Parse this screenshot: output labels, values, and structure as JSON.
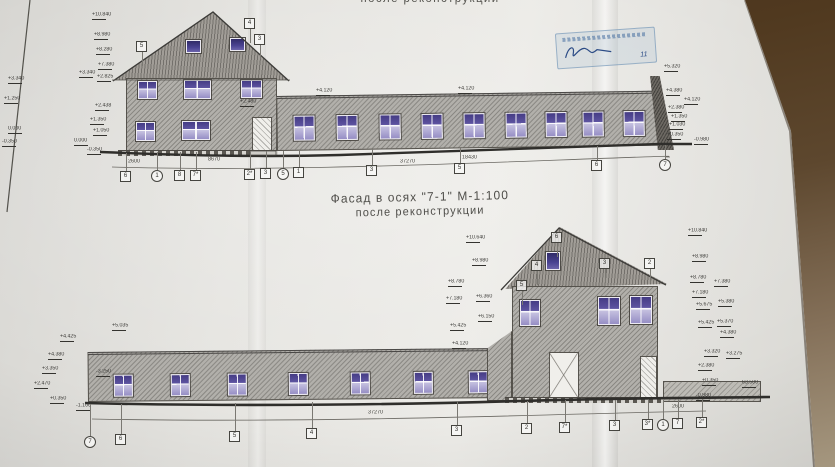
{
  "titles": {
    "top_clipped": "после реконструкции",
    "main": "Фасад в осях \"7-1\"   М-1:100",
    "sub": "после реконструкции"
  },
  "stamp": {
    "date": "11"
  },
  "top": {
    "marks": [
      {
        "v": "+10.840",
        "x": 92,
        "y": 12
      },
      {
        "v": "+8.980",
        "x": 94,
        "y": 32
      },
      {
        "v": "+8.280",
        "x": 96,
        "y": 47
      },
      {
        "v": "+7.380",
        "x": 98,
        "y": 62
      },
      {
        "v": "+2.825",
        "x": 97,
        "y": 74
      },
      {
        "v": "+3.340",
        "x": 79,
        "y": 70
      },
      {
        "v": "+2.438",
        "x": 95,
        "y": 103
      },
      {
        "v": "+1.350",
        "x": 90,
        "y": 117
      },
      {
        "v": "+1.050",
        "x": 93,
        "y": 128
      },
      {
        "v": "0.000",
        "x": 74,
        "y": 138
      },
      {
        "v": "-0.350",
        "x": 87,
        "y": 147
      },
      {
        "v": "+3.340",
        "x": 8,
        "y": 76
      },
      {
        "v": "+1.250",
        "x": 4,
        "y": 96
      },
      {
        "v": "0.000",
        "x": 8,
        "y": 126
      },
      {
        "v": "-0.350",
        "x": 2,
        "y": 139
      },
      {
        "v": "+5.320",
        "x": 664,
        "y": 64
      },
      {
        "v": "+4.380",
        "x": 666,
        "y": 88
      },
      {
        "v": "+4.120",
        "x": 684,
        "y": 97
      },
      {
        "v": "+2.380",
        "x": 668,
        "y": 105
      },
      {
        "v": "+1.350",
        "x": 671,
        "y": 114
      },
      {
        "v": "+1.030",
        "x": 669,
        "y": 122
      },
      {
        "v": "+0.350",
        "x": 667,
        "y": 132
      },
      {
        "v": "-0.980",
        "x": 694,
        "y": 137
      },
      {
        "v": "+4.120",
        "x": 316,
        "y": 88
      },
      {
        "v": "+4.120",
        "x": 458,
        "y": 86
      },
      {
        "v": "+2.480",
        "x": 240,
        "y": 99
      }
    ],
    "dims": [
      {
        "v": "2600",
        "x": 128,
        "y": 159
      },
      {
        "v": "8670",
        "x": 208,
        "y": 157
      },
      {
        "v": "37270",
        "x": 400,
        "y": 159
      },
      {
        "v": "18430",
        "x": 462,
        "y": 155
      }
    ],
    "axes": [
      {
        "l": "6",
        "t": "sq",
        "x": 126,
        "y": 177
      },
      {
        "l": "1",
        "t": "ci",
        "x": 157,
        "y": 176
      },
      {
        "l": "8",
        "t": "sq",
        "x": 180,
        "y": 176
      },
      {
        "l": "7*",
        "t": "sq",
        "x": 196,
        "y": 176
      },
      {
        "l": "2*",
        "t": "sq",
        "x": 250,
        "y": 175
      },
      {
        "l": "3",
        "t": "sq",
        "x": 266,
        "y": 174
      },
      {
        "l": "5",
        "t": "ci",
        "x": 283,
        "y": 174
      },
      {
        "l": "1",
        "t": "sq",
        "x": 299,
        "y": 173
      },
      {
        "l": "3",
        "t": "sq",
        "x": 372,
        "y": 171
      },
      {
        "l": "5",
        "t": "sq",
        "x": 460,
        "y": 169
      },
      {
        "l": "6",
        "t": "sq",
        "x": 597,
        "y": 166
      },
      {
        "l": "7",
        "t": "ci",
        "x": 665,
        "y": 165
      }
    ],
    "roof_axes": [
      {
        "l": "5",
        "x": 142,
        "y": 47
      },
      {
        "l": "4",
        "x": 250,
        "y": 24
      },
      {
        "l": "3",
        "x": 260,
        "y": 40
      }
    ]
  },
  "bottom": {
    "marks": [
      {
        "v": "+5.035",
        "x": 112,
        "y": 323
      },
      {
        "v": "+4.425",
        "x": 60,
        "y": 334
      },
      {
        "v": "+4.380",
        "x": 48,
        "y": 352
      },
      {
        "v": "+3.350",
        "x": 42,
        "y": 366
      },
      {
        "v": "-3.250",
        "x": 96,
        "y": 369
      },
      {
        "v": "+2.470",
        "x": 34,
        "y": 381
      },
      {
        "v": "+0.350",
        "x": 50,
        "y": 396
      },
      {
        "v": "-1.100",
        "x": 76,
        "y": 403
      },
      {
        "v": "+10.640",
        "x": 466,
        "y": 235
      },
      {
        "v": "+8.980",
        "x": 472,
        "y": 258
      },
      {
        "v": "+8.780",
        "x": 448,
        "y": 279
      },
      {
        "v": "+7.180",
        "x": 446,
        "y": 296
      },
      {
        "v": "+6.360",
        "x": 476,
        "y": 294
      },
      {
        "v": "+6.150",
        "x": 478,
        "y": 314
      },
      {
        "v": "+5.425",
        "x": 450,
        "y": 323
      },
      {
        "v": "+4.120",
        "x": 452,
        "y": 341
      },
      {
        "v": "+10.840",
        "x": 688,
        "y": 228
      },
      {
        "v": "+8.980",
        "x": 692,
        "y": 254
      },
      {
        "v": "+8.780",
        "x": 690,
        "y": 275
      },
      {
        "v": "+7.380",
        "x": 714,
        "y": 279
      },
      {
        "v": "+7.180",
        "x": 692,
        "y": 290
      },
      {
        "v": "+5.675",
        "x": 696,
        "y": 302
      },
      {
        "v": "+5.380",
        "x": 718,
        "y": 299
      },
      {
        "v": "+5.425",
        "x": 698,
        "y": 320
      },
      {
        "v": "+5.370",
        "x": 717,
        "y": 319
      },
      {
        "v": "+4.380",
        "x": 720,
        "y": 330
      },
      {
        "v": "+3.320",
        "x": 704,
        "y": 349
      },
      {
        "v": "+3.275",
        "x": 726,
        "y": 351
      },
      {
        "v": "+2.380",
        "x": 698,
        "y": 363
      },
      {
        "v": "+0.350",
        "x": 702,
        "y": 378
      },
      {
        "v": "63.500",
        "x": 742,
        "y": 380
      },
      {
        "v": "-0.980",
        "x": 696,
        "y": 393
      }
    ],
    "dims": [
      {
        "v": "37270",
        "x": 368,
        "y": 410
      },
      {
        "v": "2600",
        "x": 672,
        "y": 404
      }
    ],
    "axes": [
      {
        "l": "7",
        "t": "ci",
        "x": 90,
        "y": 442
      },
      {
        "l": "6",
        "t": "sq",
        "x": 121,
        "y": 440
      },
      {
        "l": "5",
        "t": "sq",
        "x": 235,
        "y": 437
      },
      {
        "l": "4",
        "t": "sq",
        "x": 312,
        "y": 434
      },
      {
        "l": "3",
        "t": "sq",
        "x": 457,
        "y": 431
      },
      {
        "l": "2",
        "t": "sq",
        "x": 527,
        "y": 429
      },
      {
        "l": "7*",
        "t": "sq",
        "x": 565,
        "y": 428
      },
      {
        "l": "3",
        "t": "sq",
        "x": 615,
        "y": 426
      },
      {
        "l": "3*",
        "t": "sq",
        "x": 648,
        "y": 425
      },
      {
        "l": "1",
        "t": "ci",
        "x": 663,
        "y": 425
      },
      {
        "l": "7",
        "t": "sq",
        "x": 678,
        "y": 424
      },
      {
        "l": "2*",
        "t": "sq",
        "x": 702,
        "y": 423
      }
    ],
    "roof_axes": [
      {
        "l": "5",
        "x": 522,
        "y": 286
      },
      {
        "l": "4",
        "x": 537,
        "y": 266
      },
      {
        "l": "6",
        "x": 557,
        "y": 238
      },
      {
        "l": "3",
        "x": 605,
        "y": 264
      },
      {
        "l": "2",
        "x": 650,
        "y": 264
      }
    ]
  }
}
